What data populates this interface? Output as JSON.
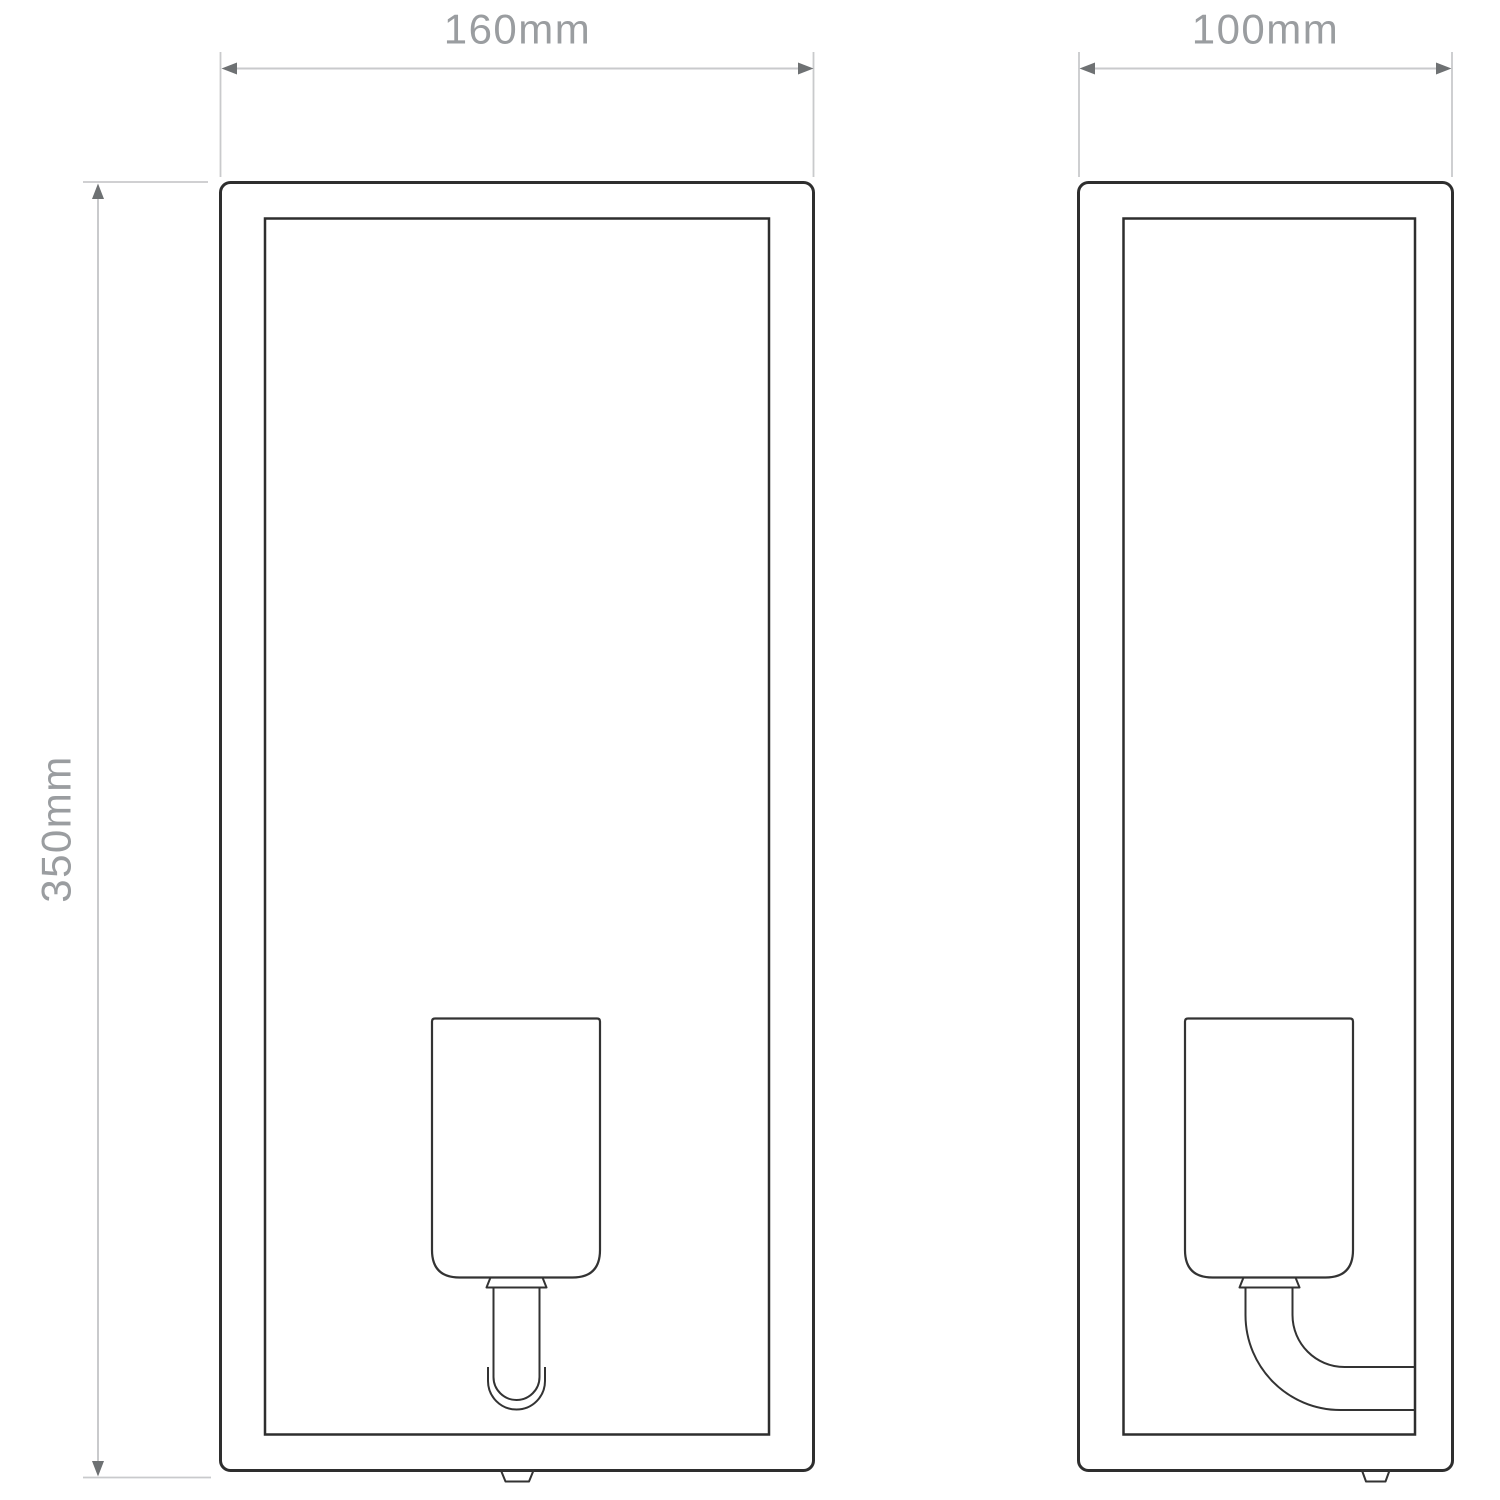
{
  "page": {
    "title": "Wall light technical dimension drawing",
    "background": "#ffffff"
  },
  "drawing": {
    "type": "technical-line-drawing",
    "views": {
      "front": {
        "name": "front elevation"
      },
      "side": {
        "name": "side elevation"
      }
    },
    "dimensions": {
      "width": {
        "label": "160mm"
      },
      "depth": {
        "label": "100mm"
      },
      "height": {
        "label": "350mm"
      }
    },
    "colors": {
      "outline": "#2e2e2e",
      "dimension_line": "#c9cacc",
      "dimension_arrow": "#6e7173",
      "dimension_text": "#9a9da0",
      "background": "#ffffff"
    }
  }
}
